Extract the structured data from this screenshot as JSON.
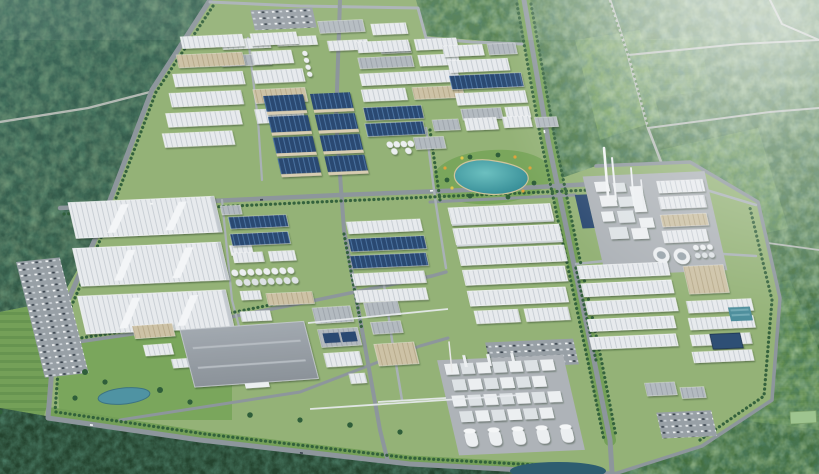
{
  "meta": {
    "type": "aerial-3d-render",
    "description": "Bird's-eye 3D architectural rendering of a large industrial park: grids of white, gray, tan and blue-roofed factory and warehouse buildings, a teal landscaped lake, tank farms, a chemical plant with chimneys and cooling towers, parking lots and tree-lined roads, surrounded by dense green forest with light haze to the upper right."
  },
  "palette": {
    "forestDarkA": "#3b655a",
    "forestDarkB": "#2f5340",
    "forestDeep": "#24432e",
    "forestRightA": "#547f4c",
    "forestRightB": "#446f3f",
    "clearing": "#74a058",
    "parkGrass": "#94b277",
    "lawn": "#7aa65c",
    "road": "#8d969c",
    "roadMinor": "#a9b1b6",
    "roadRural": "#b3bab4",
    "roofWhite": "#e7eaed",
    "roofLine": "#c9cfd5",
    "roofGray": "#b3bac0",
    "roofGrayLine": "#9fa6ad",
    "roofBlue": "#2c4a72",
    "roofBlueLine": "#48719f",
    "roofTan": "#cdc2a6",
    "roofTanLine": "#b8ab8c",
    "wall": "#d8cdb2",
    "concrete": "#aeb3b8",
    "unitWhite": "#eceff1",
    "unitShade": "#dde2e5",
    "lakeA": "#6cc0c0",
    "lakeB": "#2f8691",
    "pond": "#4f93a3",
    "pondDark": "#2e5d70",
    "poolDark": "#2e4f74",
    "poolTeal": "#4b8d9b",
    "tree": "#2f5e3a",
    "treeLight": "#52804a",
    "carWhite": "#f2f4f5",
    "carDark": "#39434d",
    "flower1": "#e0a33c",
    "flower2": "#e0c84a"
  },
  "landmarks": [
    {
      "id": "forest-top-left",
      "label": "dense dark forest, upper left"
    },
    {
      "id": "forest-right",
      "label": "forest and clearings with rural roads, right side"
    },
    {
      "id": "forest-bottom",
      "label": "dark forest belt along bottom edge"
    },
    {
      "id": "industrial-park-ground",
      "label": "industrial estate ground"
    },
    {
      "id": "north-factory-rows",
      "label": "rows of light factory buildings, top"
    },
    {
      "id": "blue-roof-factory-block",
      "label": "2x4 grid of dark blue solar roofs"
    },
    {
      "id": "lake",
      "label": "teal landscaped lake with park"
    },
    {
      "id": "large-warehouses-west",
      "label": "three very large white warehouses, left"
    },
    {
      "id": "west-parking-strip",
      "label": "parking strip, far left"
    },
    {
      "id": "tank-farm-center",
      "label": "white storage tank rows, center"
    },
    {
      "id": "gray-mega-warehouse",
      "label": "large flat gray warehouse, lower left"
    },
    {
      "id": "big-white-halls-center",
      "label": "long ridged white halls, center right"
    },
    {
      "id": "chemical-plant-east",
      "label": "chemical plant with chimneys and cooling towers"
    },
    {
      "id": "east-warehouse-rows",
      "label": "long warehouse rows, east"
    },
    {
      "id": "water-treatment-pools",
      "label": "dark blue water treatment basins"
    },
    {
      "id": "south-chemical-plant",
      "label": "dense process plant with silo row, bottom center"
    },
    {
      "id": "east-parking",
      "label": "car parking lot, lower right"
    },
    {
      "id": "small-pond",
      "label": "small pond in lawn, lower left"
    },
    {
      "id": "haze",
      "label": "atmospheric haze, upper right"
    }
  ]
}
